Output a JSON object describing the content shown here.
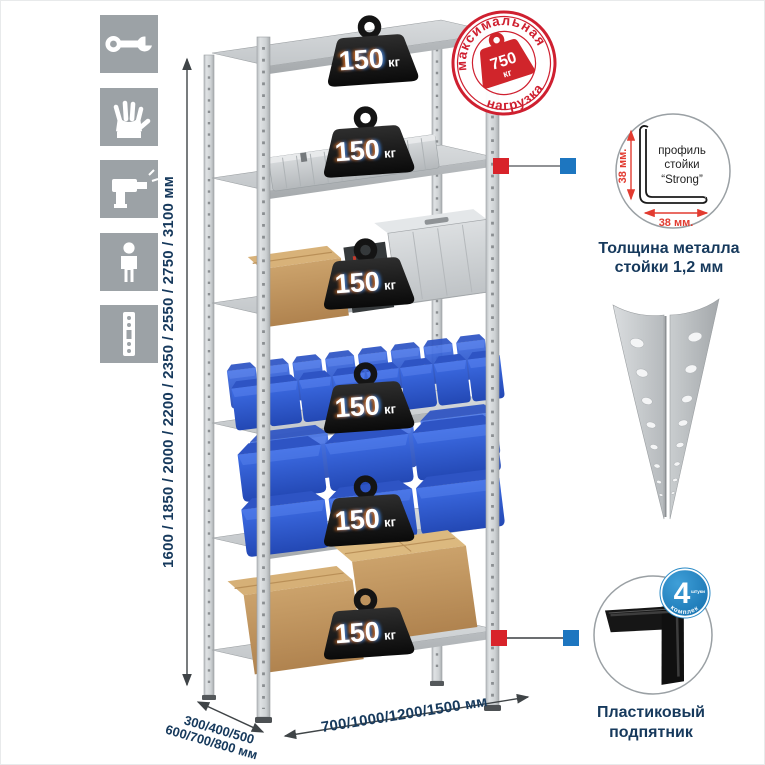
{
  "colors": {
    "accent_red": "#cf2030",
    "accent_blue": "#1d83c5",
    "navy_text": "#16395c",
    "marker_red": "#d8232a",
    "marker_blue": "#1d76c0",
    "icon_tile": "#9ca2a6"
  },
  "sidebar": {
    "icons": [
      {
        "name": "wrench"
      },
      {
        "name": "gloves"
      },
      {
        "name": "drill"
      },
      {
        "name": "person"
      },
      {
        "name": "rack-post"
      }
    ]
  },
  "dimensions": {
    "height": "1600 / 1850 / 2000 / 2200 / 2350 / 2550 / 2750 / 3100 мм",
    "depth_line1": "300/400/500",
    "depth_line2": "600/700/800 мм",
    "width": "700/1000/1200/1500 мм"
  },
  "max_load_stamp": {
    "arc_top": "максимальная",
    "arc_bottom": "нагрузка",
    "value": "750",
    "unit": "кг"
  },
  "shelf_load": {
    "value": "150",
    "unit": "кг",
    "shelf_count": 6
  },
  "profile_detail": {
    "label_line1": "профиль",
    "label_line2": "стойки",
    "label_line3": "“Strong”",
    "dim_vertical": "38 мм.",
    "dim_horizontal": "38 мм.",
    "caption_line1": "Толщина металла",
    "caption_line2": "стойки 1,2 мм"
  },
  "foot_detail": {
    "badge_value": "4",
    "badge_small": "штуки",
    "badge_arc": "в комплекте",
    "caption_line1": "Пластиковый",
    "caption_line2": "подпятник"
  }
}
